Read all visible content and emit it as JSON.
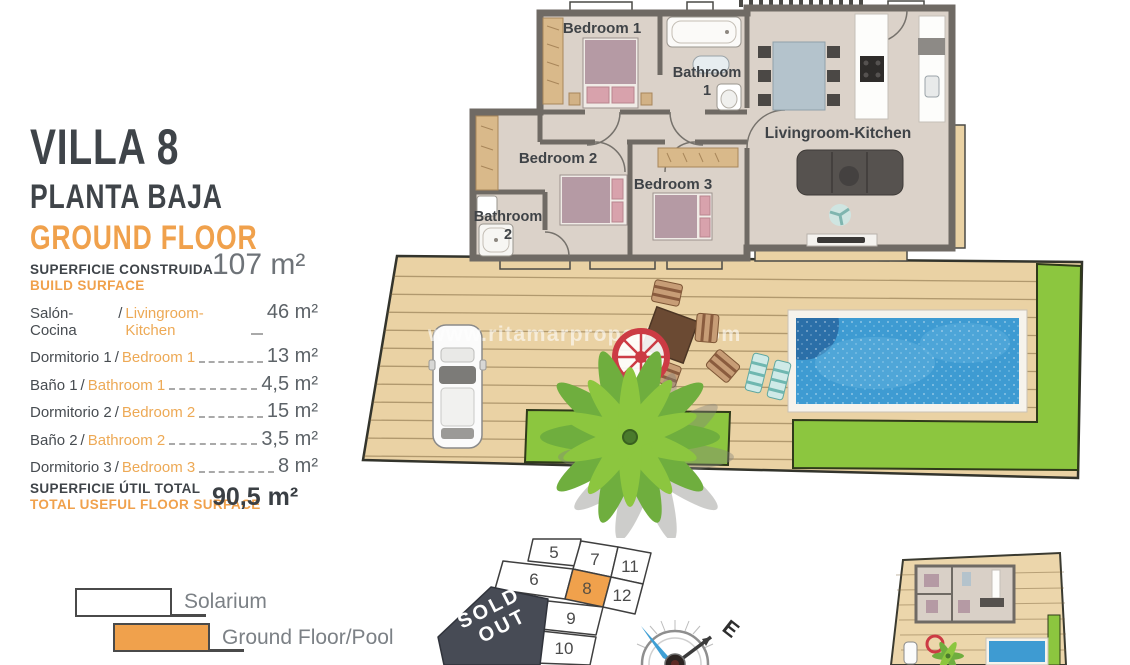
{
  "panel": {
    "title": "VILLA 8",
    "subtitle_es": "PLANTA BAJA",
    "subtitle_en": "GROUND FLOOR",
    "build_label_es": "SUPERFICIE CONSTRUIDA",
    "build_label_en": "BUILD SURFACE",
    "build_value": "107 m²",
    "separator": "/",
    "rooms": [
      {
        "es": "Salón-Cocina",
        "en": "Livingroom-Kitchen",
        "value": "46 m²"
      },
      {
        "es": "Dormitorio 1",
        "en": "Bedroom 1",
        "value": "13 m²"
      },
      {
        "es": "Baño 1",
        "en": "Bathroom 1",
        "value": "4,5 m²"
      },
      {
        "es": "Dormitorio 2",
        "en": "Bedroom 2",
        "value": "15 m²"
      },
      {
        "es": "Baño 2",
        "en": "Bathroom 2",
        "value": "3,5 m²"
      },
      {
        "es": "Dormitorio 3",
        "en": "Bedroom 3",
        "value": "8 m²"
      }
    ],
    "total_label_es": "SUPERFICIE ÚTIL TOTAL",
    "total_label_en": "TOTAL USEFUL FLOOR SURFACE",
    "total_value": "90,5 m²"
  },
  "floorplan": {
    "labels": {
      "bedroom1": "Bedroom 1",
      "bathroom1": [
        "Bathroom",
        "1"
      ],
      "bedroom2": "Bedroom 2",
      "bedroom3": "Bedroom 3",
      "bathroom2": [
        "Bathroom",
        "2"
      ],
      "living": "Livingroom-Kitchen"
    }
  },
  "watermark": "www.ritamarproperties.com",
  "legend": {
    "items": [
      {
        "label": "Solarium",
        "swatch": "#ffffff"
      },
      {
        "label": "Ground Floor/Pool",
        "swatch": "#f0a14c"
      }
    ]
  },
  "plot_map": {
    "plots": [
      "5",
      "7",
      "11",
      "6",
      "8",
      "12",
      "9",
      "10"
    ],
    "highlighted": "8",
    "sold_out": [
      "SOLD",
      "OUT"
    ]
  },
  "compass": {
    "east": "E"
  },
  "colors": {
    "accent_orange": "#f0a14c",
    "title_dark": "#3f4449",
    "wall_gray": "#6f6a64",
    "floor_beige": "#dbd2c9",
    "deck_tan": "#ead2a4",
    "grass_green": "#8cc63f",
    "pool_blue": "#3e9bd2",
    "sold_out_slate": "#474b55",
    "umbrella_red": "#cc3b44"
  }
}
